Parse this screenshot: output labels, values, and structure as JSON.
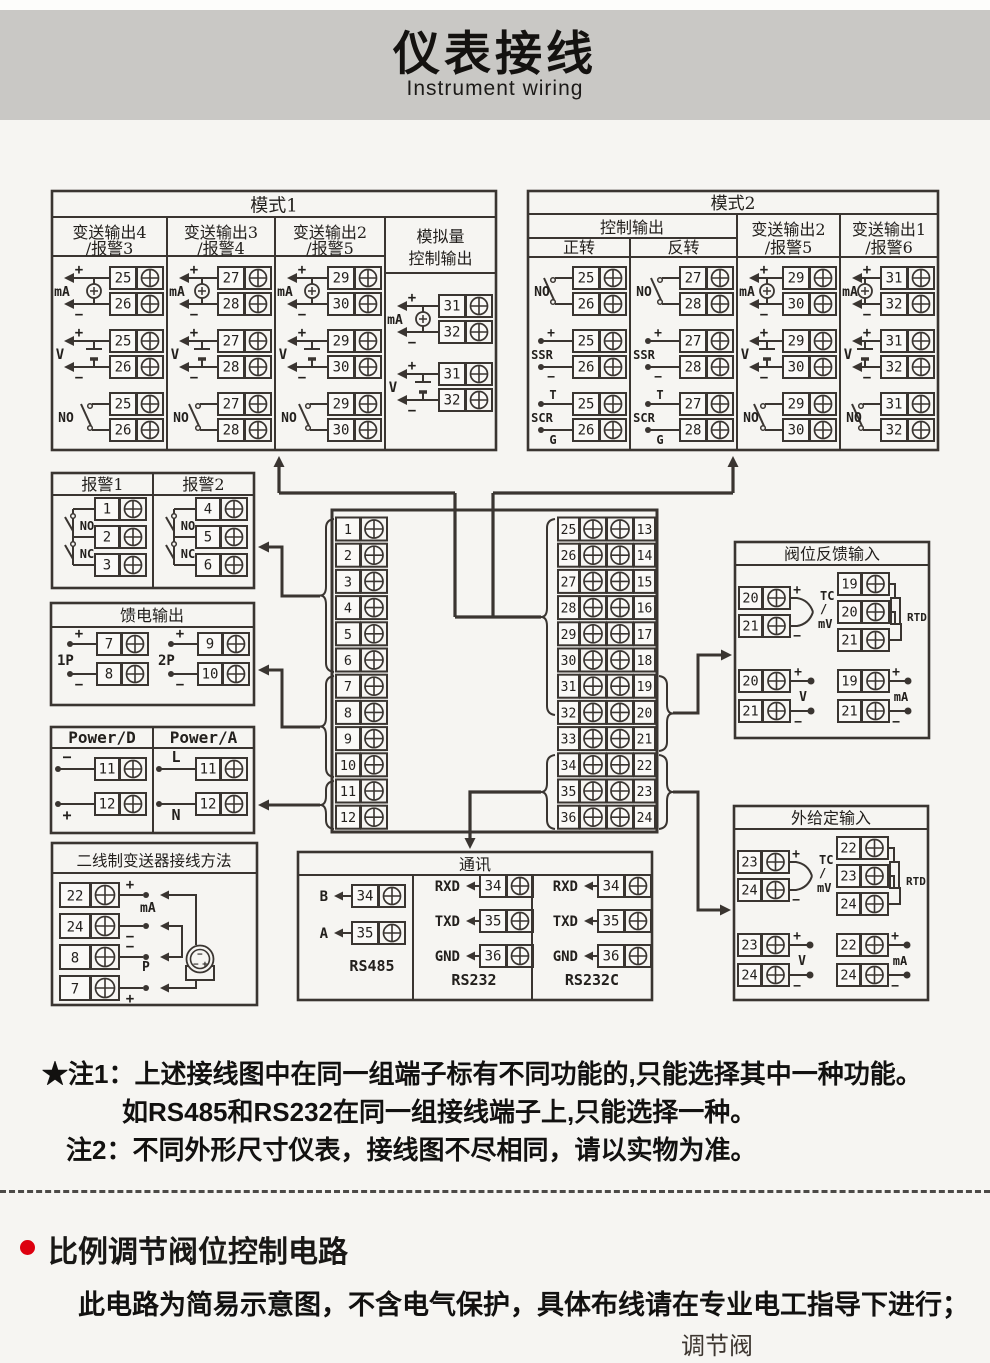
{
  "banner": {
    "title": "仪表接线",
    "subtitle": "Instrument wiring"
  },
  "colors": {
    "line": "#3a3531",
    "text": "#23201d",
    "banner_bg": "#c9c8c5",
    "page_bg": "#f6f5f2",
    "accent_red": "#dd000f"
  },
  "symbols": {
    "plus": "+",
    "minus": "−",
    "no": "NO",
    "nc": "NC",
    "ssr": "SSR",
    "scr": "SCR",
    "scr_t": "T",
    "scr_g": "G",
    "ma": "mA",
    "v": "V"
  },
  "mode1": {
    "title": "模式1",
    "columns": [
      {
        "header": [
          "变送输出4",
          "/报警3"
        ],
        "cells": [
          {
            "icon": "mA",
            "terminals": [
              "25",
              "26"
            ]
          },
          {
            "icon": "V",
            "terminals": [
              "25",
              "26"
            ]
          },
          {
            "icon": "NO",
            "terminals": [
              "25",
              "26"
            ]
          }
        ]
      },
      {
        "header": [
          "变送输出3",
          "/报警4"
        ],
        "cells": [
          {
            "icon": "mA",
            "terminals": [
              "27",
              "28"
            ]
          },
          {
            "icon": "V",
            "terminals": [
              "27",
              "28"
            ]
          },
          {
            "icon": "NO",
            "terminals": [
              "27",
              "28"
            ]
          }
        ]
      },
      {
        "header": [
          "变送输出2",
          "/报警5"
        ],
        "cells": [
          {
            "icon": "mA",
            "terminals": [
              "29",
              "30"
            ]
          },
          {
            "icon": "V",
            "terminals": [
              "29",
              "30"
            ]
          },
          {
            "icon": "NO",
            "terminals": [
              "29",
              "30"
            ]
          }
        ]
      },
      {
        "header": [
          "模拟量",
          "控制输出"
        ],
        "cells": [
          {
            "icon": "mA",
            "terminals": [
              "31",
              "32"
            ]
          },
          {
            "icon": "V",
            "terminals": [
              "31",
              "32"
            ]
          }
        ]
      }
    ]
  },
  "mode2": {
    "title": "模式2",
    "group_header": "控制输出",
    "columns": [
      {
        "header": [
          "正转"
        ],
        "cells": [
          {
            "icon": "NO",
            "terminals": [
              "25",
              "26"
            ]
          },
          {
            "icon": "SSR",
            "terminals": [
              "25",
              "26"
            ]
          },
          {
            "icon": "SCR",
            "terminals": [
              "25",
              "26"
            ]
          }
        ]
      },
      {
        "header": [
          "反转"
        ],
        "cells": [
          {
            "icon": "NO",
            "terminals": [
              "27",
              "28"
            ]
          },
          {
            "icon": "SSR",
            "terminals": [
              "27",
              "28"
            ]
          },
          {
            "icon": "SCR",
            "terminals": [
              "27",
              "28"
            ]
          }
        ]
      },
      {
        "header": [
          "变送输出2",
          "/报警5"
        ],
        "cells": [
          {
            "icon": "mA",
            "terminals": [
              "29",
              "30"
            ]
          },
          {
            "icon": "V",
            "terminals": [
              "29",
              "30"
            ]
          },
          {
            "icon": "NO",
            "terminals": [
              "29",
              "30"
            ]
          }
        ]
      },
      {
        "header": [
          "变送输出1",
          "/报警6"
        ],
        "cells": [
          {
            "icon": "mA",
            "terminals": [
              "31",
              "32"
            ]
          },
          {
            "icon": "V",
            "terminals": [
              "31",
              "32"
            ]
          },
          {
            "icon": "NO",
            "terminals": [
              "31",
              "32"
            ]
          }
        ]
      }
    ]
  },
  "alarm_box": {
    "columns": [
      {
        "header": "报警1",
        "terminals": [
          "1",
          "2",
          "3"
        ]
      },
      {
        "header": "报警2",
        "terminals": [
          "4",
          "5",
          "6"
        ]
      }
    ],
    "no_label": "NO",
    "nc_label": "NC"
  },
  "feed_box": {
    "title": "馈电输出",
    "groups": [
      {
        "label": "1P",
        "terminals": [
          "7",
          "8"
        ]
      },
      {
        "label": "2P",
        "terminals": [
          "9",
          "10"
        ]
      }
    ]
  },
  "power_box": {
    "columns": [
      {
        "header": "Power/D",
        "rows": [
          {
            "label": "−",
            "terminal": "11"
          },
          {
            "label": "+",
            "terminal": "12"
          }
        ]
      },
      {
        "header": "Power/A",
        "rows": [
          {
            "label": "L",
            "terminal": "11"
          },
          {
            "label": "N",
            "terminal": "12"
          }
        ]
      }
    ]
  },
  "twowire_box": {
    "title": "二线制变送器接线方法",
    "rows": [
      {
        "terminal": "22",
        "sign": "+"
      },
      {
        "terminal": "24",
        "sign": "−"
      },
      {
        "terminal": "8",
        "sign": "−"
      },
      {
        "terminal": "7",
        "sign": "+"
      }
    ],
    "mid_labels": [
      "mA",
      "P"
    ]
  },
  "terminal_block": {
    "left": [
      "1",
      "2",
      "3",
      "4",
      "5",
      "6",
      "7",
      "8",
      "9",
      "10",
      "11",
      "12"
    ],
    "mid": [
      "25",
      "26",
      "27",
      "28",
      "29",
      "30",
      "31",
      "32",
      "33",
      "34",
      "35",
      "36"
    ],
    "right": [
      "13",
      "14",
      "15",
      "16",
      "17",
      "18",
      "19",
      "20",
      "21",
      "22",
      "23",
      "24"
    ]
  },
  "comm_box": {
    "title": "通讯",
    "sections": [
      {
        "label": "RS485",
        "pins": [
          [
            "B",
            "34"
          ],
          [
            "A",
            "35"
          ]
        ]
      },
      {
        "label": "RS232",
        "pins": [
          [
            "RXD",
            "34"
          ],
          [
            "TXD",
            "35"
          ],
          [
            "GND",
            "36"
          ]
        ]
      },
      {
        "label": "RS232C",
        "pins": [
          [
            "RXD",
            "34"
          ],
          [
            "TXD",
            "35"
          ],
          [
            "GND",
            "36"
          ]
        ]
      }
    ]
  },
  "valve_feedback_box": {
    "title": "阀位反馈输入",
    "tc": {
      "terminals": [
        "20",
        "21"
      ],
      "labels": [
        "TC",
        "/",
        "mV"
      ]
    },
    "rtd": {
      "terminals": [
        "19",
        "20",
        "21"
      ],
      "label": "RTD"
    },
    "volt": {
      "terminals": [
        "20",
        "21"
      ],
      "label": "V"
    },
    "milliamp": {
      "terminals": [
        "19",
        "21"
      ],
      "label": "mA"
    }
  },
  "external_input_box": {
    "title": "外给定输入",
    "tc": {
      "terminals": [
        "23",
        "24"
      ],
      "labels": [
        "TC",
        "/",
        "mV"
      ]
    },
    "rtd": {
      "terminals": [
        "22",
        "23",
        "24"
      ],
      "label": "RTD"
    },
    "volt": {
      "terminals": [
        "23",
        "24"
      ],
      "label": "V"
    },
    "milliamp": {
      "terminals": [
        "22",
        "24"
      ],
      "label": "mA"
    }
  },
  "notes": {
    "line1_head": "★注1：",
    "line1": "上述接线图中在同一组端子标有不同功能的,只能选择其中一种功能。",
    "line2": "如RS485和RS232在同一组接线端子上,只能选择一种。",
    "line3_head": "注2：",
    "line3": "不同外形尺寸仪表，接线图不尽相同，请以实物为准。"
  },
  "bottom": {
    "heading": "比例调节阀位控制电路",
    "body": "此电路为简易示意图，不含电气保护，具体布线请在专业电工指导下进行；",
    "caption": "调节阀"
  }
}
